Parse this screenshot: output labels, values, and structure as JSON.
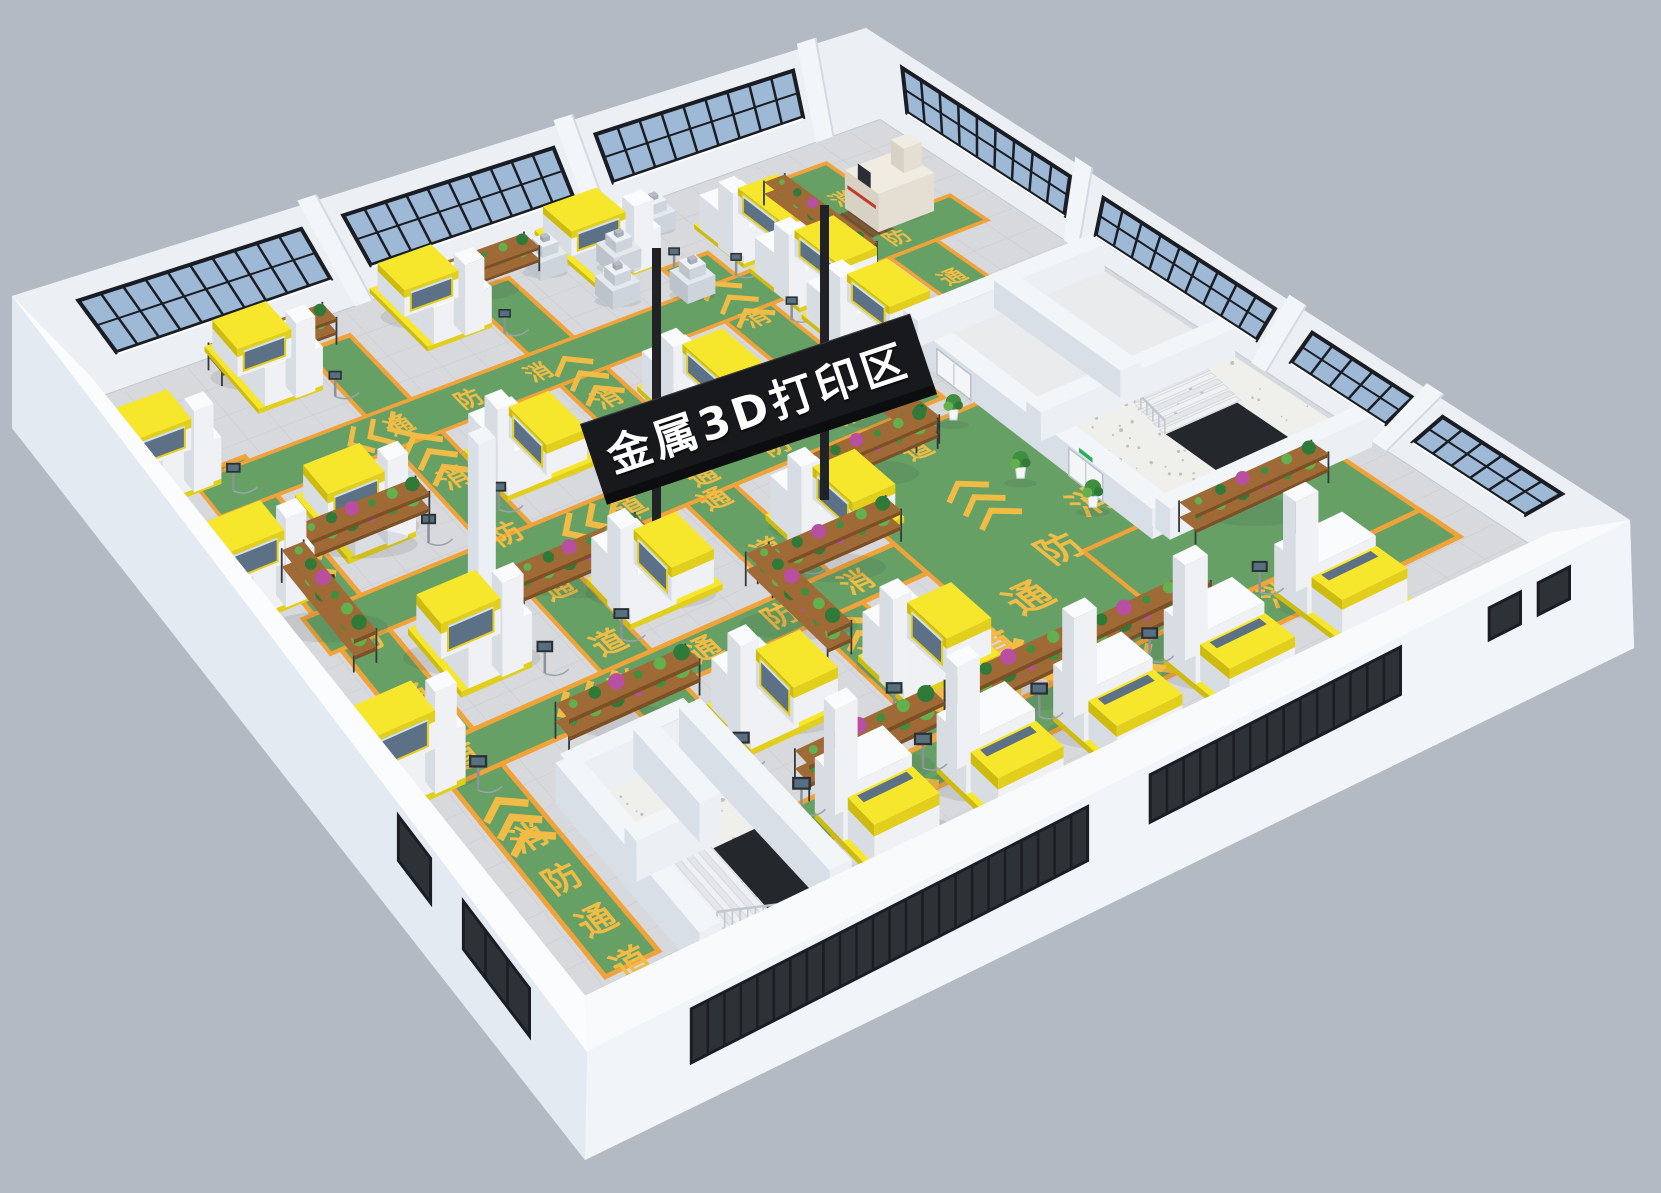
{
  "page": {
    "background": "#b3bac4"
  },
  "zone_sign": {
    "label": "金属3D打印区",
    "panel_color": "#17191d",
    "panel_bottom_color": "#0c0d0f",
    "pole_color": "#202225",
    "text_color": "#ffffff"
  },
  "floor_marking": {
    "label": "消防通道",
    "chars": [
      "消",
      "防",
      "通",
      "道"
    ],
    "color": "#f1bc45"
  },
  "exit_sign": {
    "color": "#2fae5f"
  },
  "palette": {
    "background": "#b3bac4",
    "floor": "#d7d9dc",
    "floor_grid": "#c9ccd0",
    "aisle_green": "#67a065",
    "aisle_border": "#f1a339",
    "wall_light": "#f3f6f9",
    "wall_mid": "#eceff4",
    "wall_shadow": "#d9dfe7",
    "wall_top_ring": "#eef1f5",
    "slab_left": "#e4eaf2",
    "slab_right": "#f1f5fa",
    "glass_blue": "#9db9d6",
    "glass_dark": "#2d3237",
    "frame_dark": "#1a1e24",
    "machine_white": "#eff1f4",
    "machine_side": "#d8dde3",
    "machine_top": "#fafbfd",
    "machine_yellow": "#f7e72c",
    "machine_yellow_shade": "#e2cf1c",
    "machine_yellow_dark": "#cdbb12",
    "machine_glass": "#5d7186",
    "machine_glass_sheen": "#cfe0ef",
    "bench_gray_top": "#e5e9ee",
    "bench_gray_r": "#cdd4db",
    "bench_gray_l": "#bcc3cb",
    "cmm_top": "#f0ece1",
    "cmm_r": "#e4dfd2",
    "cmm_l": "#d7d2c4",
    "cmm_red": "#c0392b",
    "mat_brown": "#7c5a36",
    "mat_line": "#6b4c2e",
    "terrazzo": "#efefeb",
    "speckle": "#b9b9b1",
    "stair_void": "#24282d",
    "railing": "#c2c8cf",
    "step_a": "#eef0f3",
    "step_b": "#e3e6ea",
    "shelf_wood": "#a06a36",
    "shelf_wood_dark": "#7c4f25",
    "shelf_frame": "#34383d",
    "plant_greens": [
      "#3f8f3f",
      "#63b04e",
      "#2f7a38",
      "#57a34b"
    ],
    "plant_accents": [
      "#b84fa0",
      "#d95c8e",
      "#c74f6d"
    ],
    "pot_white": "#f4f6f8",
    "door_white": "#f3f5f7",
    "door_frame": "#b9c0c8",
    "shadow": "rgba(40,50,60,0.10)"
  },
  "aisles": {
    "half_width": 0.028,
    "v_lanes": [
      {
        "u": 0.075,
        "v0": 0.14,
        "v1": 0.95
      },
      {
        "u": 0.275,
        "v0": 0.035,
        "v1": 0.7
      },
      {
        "u": 0.475,
        "v0": 0.035,
        "v1": 0.85
      },
      {
        "u": 0.675,
        "v0": 0.1,
        "v1": 0.85
      },
      {
        "u": 0.875,
        "v0": 0.035,
        "v1": 0.82
      }
    ],
    "u_lanes": [
      {
        "v": 0.175,
        "u0": 0.035,
        "u1": 0.965
      },
      {
        "v": 0.395,
        "u0": 0.035,
        "u1": 0.745
      },
      {
        "v": 0.615,
        "u0": 0.035,
        "u1": 0.575
      }
    ],
    "walkway": {
      "u0": 0.21,
      "u1": 0.965,
      "v0": 0.855,
      "v1": 0.915
    },
    "plaza": {
      "u0": 0.575,
      "u1": 0.875,
      "v0": 0.45,
      "v1": 0.875
    },
    "right_patch": {
      "u0": 0.705,
      "u1": 0.965,
      "v0": 0.705,
      "v1": 0.915
    }
  },
  "floor_texts": [
    {
      "u": 0.075,
      "v": 0.33,
      "du": 0,
      "dv": 0.095,
      "n": 4,
      "start": 0,
      "size": 1
    },
    {
      "u": 0.075,
      "v": 0.745,
      "du": 0,
      "dv": 0.068,
      "n": 4,
      "start": 0,
      "size": 0.95
    },
    {
      "u": 0.275,
      "v": 0.27,
      "du": 0,
      "dv": 0.095,
      "n": 4,
      "start": 0,
      "size": 1
    },
    {
      "u": 0.475,
      "v": 0.245,
      "du": 0,
      "dv": 0.093,
      "n": 4,
      "start": 0,
      "size": 1
    },
    {
      "u": 0.475,
      "v": 0.715,
      "du": 0,
      "dv": 0.07,
      "n": 2,
      "start": 2,
      "size": 0.95
    },
    {
      "u": 0.675,
      "v": 0.215,
      "du": 0,
      "dv": 0.088,
      "n": 4,
      "start": 0,
      "size": 1
    },
    {
      "u": 0.875,
      "v": 0.095,
      "du": 0,
      "dv": 0.085,
      "n": 3,
      "start": 0,
      "size": 1
    },
    {
      "u": 0.655,
      "v": 0.395,
      "du": -0.085,
      "dv": 0,
      "n": 4,
      "start": 0,
      "size": 1
    },
    {
      "u": 0.515,
      "v": 0.615,
      "du": -0.085,
      "dv": 0,
      "n": 4,
      "start": 0,
      "size": 1
    },
    {
      "u": 0.44,
      "v": 0.175,
      "du": -0.085,
      "dv": 0,
      "n": 3,
      "start": 0,
      "size": 0.95
    },
    {
      "u": 0.755,
      "v": 0.645,
      "du": -0.064,
      "dv": 0.044,
      "n": 4,
      "start": 0,
      "size": 1.35
    },
    {
      "u": 0.8,
      "v": 0.878,
      "du": -0.082,
      "dv": 0.006,
      "n": 2,
      "start": 0,
      "size": 1.1
    }
  ],
  "chevrons": [
    {
      "u": 0.075,
      "v": 0.255,
      "dir": "-v",
      "scale": 1
    },
    {
      "u": 0.075,
      "v": 0.685,
      "dir": "-v",
      "scale": 1
    },
    {
      "u": 0.275,
      "v": 0.195,
      "dir": "-v",
      "scale": 1
    },
    {
      "u": 0.475,
      "v": 0.17,
      "dir": "-v",
      "scale": 1
    },
    {
      "u": 0.475,
      "v": 0.655,
      "dir": "-v",
      "scale": 0.9
    },
    {
      "u": 0.675,
      "v": 0.145,
      "dir": "-v",
      "scale": 1
    },
    {
      "u": 0.675,
      "v": 0.545,
      "dir": "-v",
      "scale": 1
    },
    {
      "u": 0.875,
      "v": 0.35,
      "dir": "-v",
      "scale": 1
    },
    {
      "u": 0.325,
      "v": 0.395,
      "dir": "-u",
      "scale": 1
    },
    {
      "u": 0.185,
      "v": 0.615,
      "dir": "-u",
      "scale": 1
    },
    {
      "u": 0.21,
      "v": 0.175,
      "dir": "-u",
      "scale": 0.9
    },
    {
      "u": 0.475,
      "v": 0.815,
      "dir": "-u",
      "scale": 1.5
    },
    {
      "u": 0.815,
      "v": 0.598,
      "dir": "-u",
      "scale": 1.4
    },
    {
      "u": 0.62,
      "v": 0.888,
      "dir": "-u",
      "scale": 1.1
    },
    {
      "u": 0.33,
      "v": 0.885,
      "dir": "-u",
      "scale": 1.2
    }
  ],
  "printers": [
    {
      "u": 0.19,
      "v": 0.045,
      "face": "+v"
    },
    {
      "u": 0.4,
      "v": 0.045,
      "face": "+v"
    },
    {
      "u": 0.61,
      "v": 0.045,
      "face": "+v"
    },
    {
      "u": 0.02,
      "v": 0.115,
      "face": "+v"
    },
    {
      "u": 0.02,
      "v": 0.3,
      "face": "+v"
    },
    {
      "u": 0.02,
      "v": 0.6,
      "face": "+v"
    },
    {
      "u": 0.155,
      "v": 0.275,
      "face": "+v"
    },
    {
      "u": 0.35,
      "v": 0.285,
      "face": "-u"
    },
    {
      "u": 0.555,
      "v": 0.29,
      "face": "-u"
    },
    {
      "u": 0.76,
      "v": 0.28,
      "face": "-u"
    },
    {
      "u": 0.155,
      "v": 0.495,
      "face": "+v"
    },
    {
      "u": 0.35,
      "v": 0.51,
      "face": "-u"
    },
    {
      "u": 0.545,
      "v": 0.525,
      "face": "-u"
    },
    {
      "u": 0.35,
      "v": 0.73,
      "face": "-u"
    },
    {
      "u": 0.5,
      "v": 0.755,
      "face": "-u"
    },
    {
      "u": 0.765,
      "v": 0.1,
      "face": "-u"
    },
    {
      "u": 0.765,
      "v": 0.19,
      "face": "-u"
    },
    {
      "u": 0.345,
      "v": 0.93,
      "face": "-v"
    },
    {
      "u": 0.465,
      "v": 0.945,
      "face": "-v"
    },
    {
      "u": 0.585,
      "v": 0.95,
      "face": "-v"
    },
    {
      "u": 0.705,
      "v": 0.945,
      "face": "-v"
    },
    {
      "u": 0.835,
      "v": 0.925,
      "face": "-v"
    }
  ],
  "bench_machines": [
    {
      "u": 0.545,
      "v": 0.04
    },
    {
      "u": 0.615,
      "v": 0.07
    },
    {
      "u": 0.685,
      "v": 0.035
    },
    {
      "u": 0.755,
      "v": 0.065
    },
    {
      "u": 0.58,
      "v": 0.115
    },
    {
      "u": 0.65,
      "v": 0.145
    }
  ],
  "cmm_machine": {
    "u": 0.9,
    "v": 0.135,
    "mat": {
      "u0": 0.84,
      "v0": 0.115,
      "u1": 0.882,
      "v1": 0.165
    }
  },
  "shelves": [
    {
      "u": 0.21,
      "v": 0.028,
      "dir": "u"
    },
    {
      "u": 0.465,
      "v": 0.028,
      "dir": "u"
    },
    {
      "u": 0.145,
      "v": 0.3,
      "dir": "u"
    },
    {
      "u": 0.3,
      "v": 0.46,
      "dir": "u"
    },
    {
      "u": 0.055,
      "v": 0.385,
      "dir": "v"
    },
    {
      "u": 0.235,
      "v": 0.655,
      "dir": "u"
    },
    {
      "u": 0.44,
      "v": 0.63,
      "dir": "v"
    },
    {
      "u": 0.51,
      "v": 0.575,
      "dir": "u"
    },
    {
      "u": 0.62,
      "v": 0.475,
      "dir": "u"
    },
    {
      "u": 0.685,
      "v": 0.41,
      "dir": "v"
    },
    {
      "u": 0.815,
      "v": 0.135,
      "dir": "v"
    },
    {
      "u": 0.545,
      "v": 0.845,
      "dir": "u"
    },
    {
      "u": 0.385,
      "v": 0.845,
      "dir": "u"
    },
    {
      "u": 0.86,
      "v": 0.75,
      "dir": "u"
    },
    {
      "u": 0.665,
      "v": 0.85,
      "dir": "u"
    }
  ],
  "potted_plants": [
    {
      "u": 0.73,
      "v": 0.46
    },
    {
      "u": 0.725,
      "v": 0.575
    },
    {
      "u": 0.75,
      "v": 0.655
    }
  ],
  "support_columns": [
    {
      "u": 0.215,
      "v": 0.415
    }
  ],
  "rooms_left": {
    "u0": 0.13,
    "v0": 0.72,
    "u1": 0.265,
    "v1": 1.0,
    "walls": [
      {
        "u0": 0.13,
        "v0": 0.72,
        "u1": 0.265,
        "v1": 0.72
      },
      {
        "u0": 0.265,
        "v0": 0.72,
        "u1": 0.265,
        "v1": 1.0
      },
      {
        "u0": 0.13,
        "v0": 0.72,
        "u1": 0.13,
        "v1": 1.0
      },
      {
        "u0": 0.13,
        "v0": 0.845,
        "u1": 0.215,
        "v1": 0.845
      },
      {
        "u0": 0.215,
        "v0": 0.72,
        "u1": 0.215,
        "v1": 0.845
      }
    ],
    "stair": {
      "hole": {
        "u0": 0.21,
        "v0": 0.86,
        "u1": 0.258,
        "v1": 0.985
      },
      "steps": {
        "n": 9,
        "uA": 0.138,
        "uB": 0.21,
        "v0": 0.855,
        "v1": 0.985
      }
    }
  },
  "rooms_right": {
    "u0": 0.775,
    "v0": 0.33,
    "u1": 0.995,
    "v1": 0.73,
    "walls": [
      {
        "u0": 0.775,
        "v0": 0.33,
        "u1": 0.775,
        "v1": 0.73
      },
      {
        "u0": 0.775,
        "v0": 0.33,
        "u1": 0.995,
        "v1": 0.33
      },
      {
        "u0": 0.775,
        "v0": 0.525,
        "u1": 0.995,
        "v1": 0.525
      },
      {
        "u0": 0.775,
        "v0": 0.73,
        "u1": 0.995,
        "v1": 0.73
      },
      {
        "u0": 0.885,
        "v0": 0.33,
        "u1": 0.885,
        "v1": 0.525
      }
    ],
    "doors": [
      {
        "v": 0.415,
        "exit_sign": false
      },
      {
        "v": 0.625,
        "exit_sign": true
      }
    ],
    "stair": {
      "hole": {
        "u0": 0.87,
        "v0": 0.6,
        "u1": 0.95,
        "v1": 0.71
      },
      "steps": {
        "n": 7,
        "vA": 0.535,
        "vB": 0.6,
        "u0": 0.87,
        "u1": 0.955
      }
    }
  },
  "back_left_wall": {
    "window_sections": [
      [
        0.06,
        0.325
      ],
      [
        0.375,
        0.625
      ],
      [
        0.675,
        0.91
      ]
    ],
    "pilasters": [
      0.345,
      0.645,
      0.93
    ]
  },
  "back_right_wall": {
    "window_sections": [
      [
        0.045,
        0.27
      ],
      [
        0.315,
        0.545
      ],
      [
        0.595,
        0.73
      ],
      [
        0.77,
        0.93
      ]
    ],
    "pilasters": [
      0.285,
      0.565,
      0.745
    ]
  },
  "front_right_wall": {
    "band_sections": [
      [
        0.1,
        0.48
      ],
      [
        0.54,
        0.78
      ]
    ],
    "small_windows": [
      [
        0.865,
        0.895
      ],
      [
        0.912,
        0.942
      ]
    ]
  },
  "front_left_wall": {
    "windows": [
      [
        0.1,
        0.215
      ],
      [
        0.272,
        0.328
      ]
    ]
  }
}
